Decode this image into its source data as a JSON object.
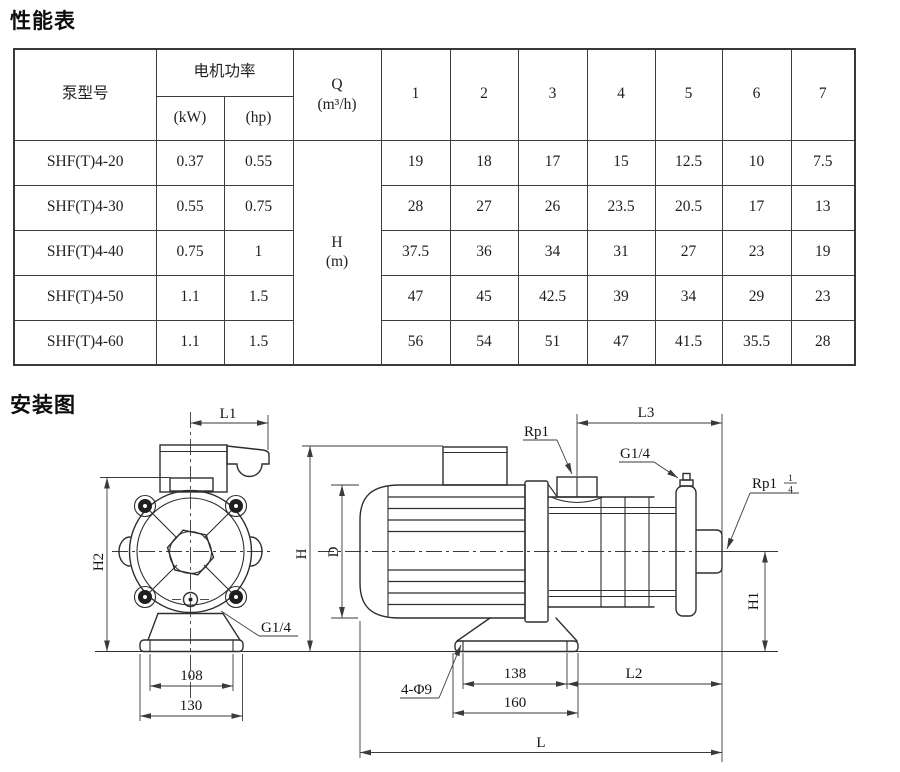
{
  "colors": {
    "ink": "#1b1b1b",
    "line": "#2e2e2e",
    "background": "#ffffff"
  },
  "performance": {
    "title": "性能表",
    "header": {
      "pump_model": "泵型号",
      "motor_power": "电机功率",
      "kw": "(kW)",
      "hp": "(hp)",
      "q_label": "Q",
      "q_unit": "(m³/h)",
      "h_label": "H",
      "h_unit": "(m)",
      "flow_cols": [
        "1",
        "2",
        "3",
        "4",
        "5",
        "6",
        "7"
      ]
    },
    "rows": [
      {
        "model": "SHF(T)4-20",
        "kw": "0.37",
        "hp": "0.55",
        "values": [
          "19",
          "18",
          "17",
          "15",
          "12.5",
          "10",
          "7.5"
        ]
      },
      {
        "model": "SHF(T)4-30",
        "kw": "0.55",
        "hp": "0.75",
        "values": [
          "28",
          "27",
          "26",
          "23.5",
          "20.5",
          "17",
          "13"
        ]
      },
      {
        "model": "SHF(T)4-40",
        "kw": "0.75",
        "hp": "1",
        "values": [
          "37.5",
          "36",
          "34",
          "31",
          "27",
          "23",
          "19"
        ]
      },
      {
        "model": "SHF(T)4-50",
        "kw": "1.1",
        "hp": "1.5",
        "values": [
          "47",
          "45",
          "42.5",
          "39",
          "34",
          "29",
          "23"
        ]
      },
      {
        "model": "SHF(T)4-60",
        "kw": "1.1",
        "hp": "1.5",
        "values": [
          "56",
          "54",
          "51",
          "47",
          "41.5",
          "35.5",
          "28"
        ]
      }
    ]
  },
  "installation": {
    "title": "安装图",
    "labels": {
      "l1": "L1",
      "h2": "H2",
      "g14_front": "G1/4",
      "d108": "108",
      "d130": "130",
      "h": "H",
      "d": "D",
      "rp1": "Rp1",
      "l3": "L3",
      "g14_side": "G1/4",
      "rp114_base": "Rp1",
      "rp114_num": "1",
      "rp114_den": "4",
      "h1": "H1",
      "holes": "4-Φ9",
      "d138": "138",
      "l2": "L2",
      "d160": "160",
      "l": "L"
    }
  }
}
